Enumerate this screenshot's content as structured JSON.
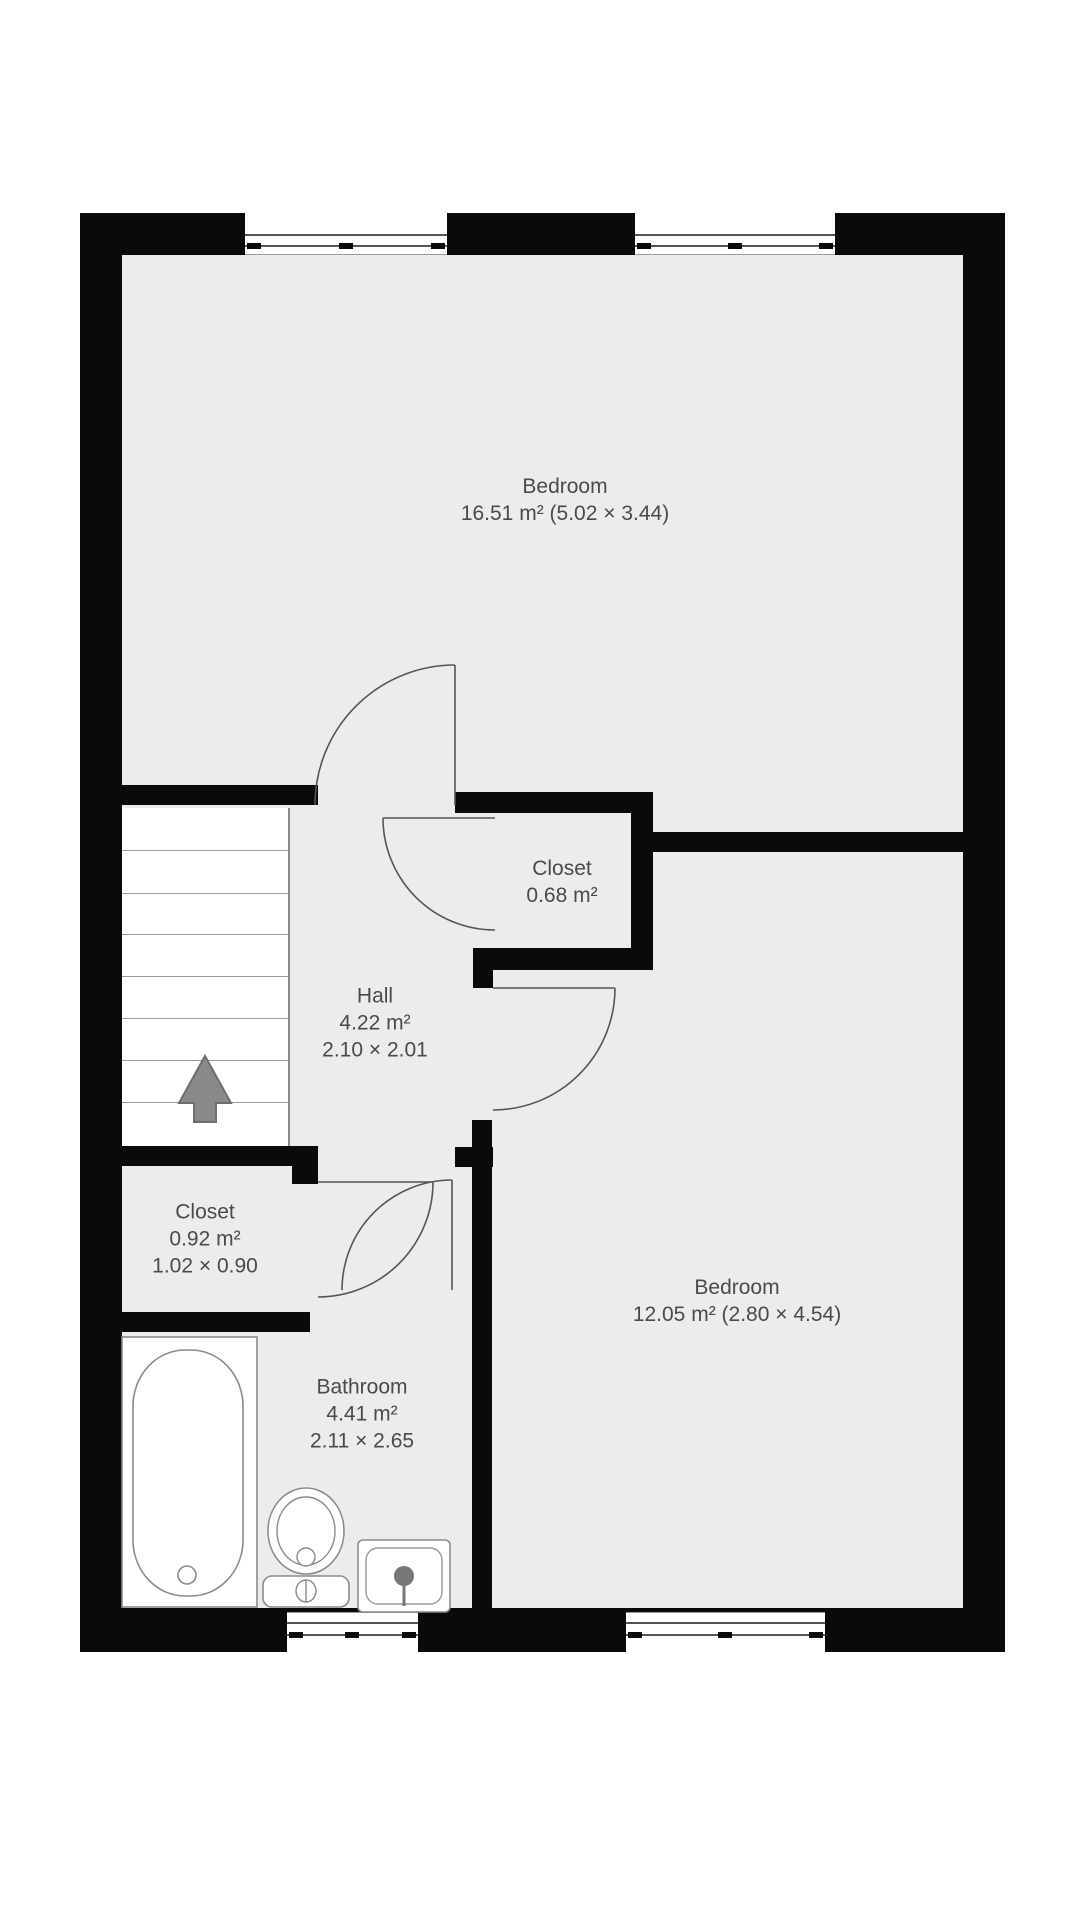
{
  "floorplan": {
    "rooms": {
      "bedroom_top": {
        "name": "Bedroom",
        "details": "16.51 m² (5.02 × 3.44)"
      },
      "closet_small": {
        "name": "Closet",
        "area": "0.68 m²"
      },
      "hall": {
        "name": "Hall",
        "area": "4.22 m²",
        "dimensions": "2.10 × 2.01"
      },
      "closet_left": {
        "name": "Closet",
        "area": "0.92 m²",
        "dimensions": "1.02 × 0.90"
      },
      "bathroom": {
        "name": "Bathroom",
        "area": "4.41 m²",
        "dimensions": "2.11 × 2.65"
      },
      "bedroom_bottom": {
        "name": "Bedroom",
        "details": "12.05 m² (2.80 × 4.54)"
      }
    },
    "icons": {
      "stairs_arrow": "up-arrow"
    },
    "colors": {
      "wall": "#0a0a0a",
      "floor": "#ececee",
      "label_text": "#4a4a4a",
      "fixture_stroke": "#8a8a8a",
      "arrow_fill": "#8a8a8a"
    }
  }
}
